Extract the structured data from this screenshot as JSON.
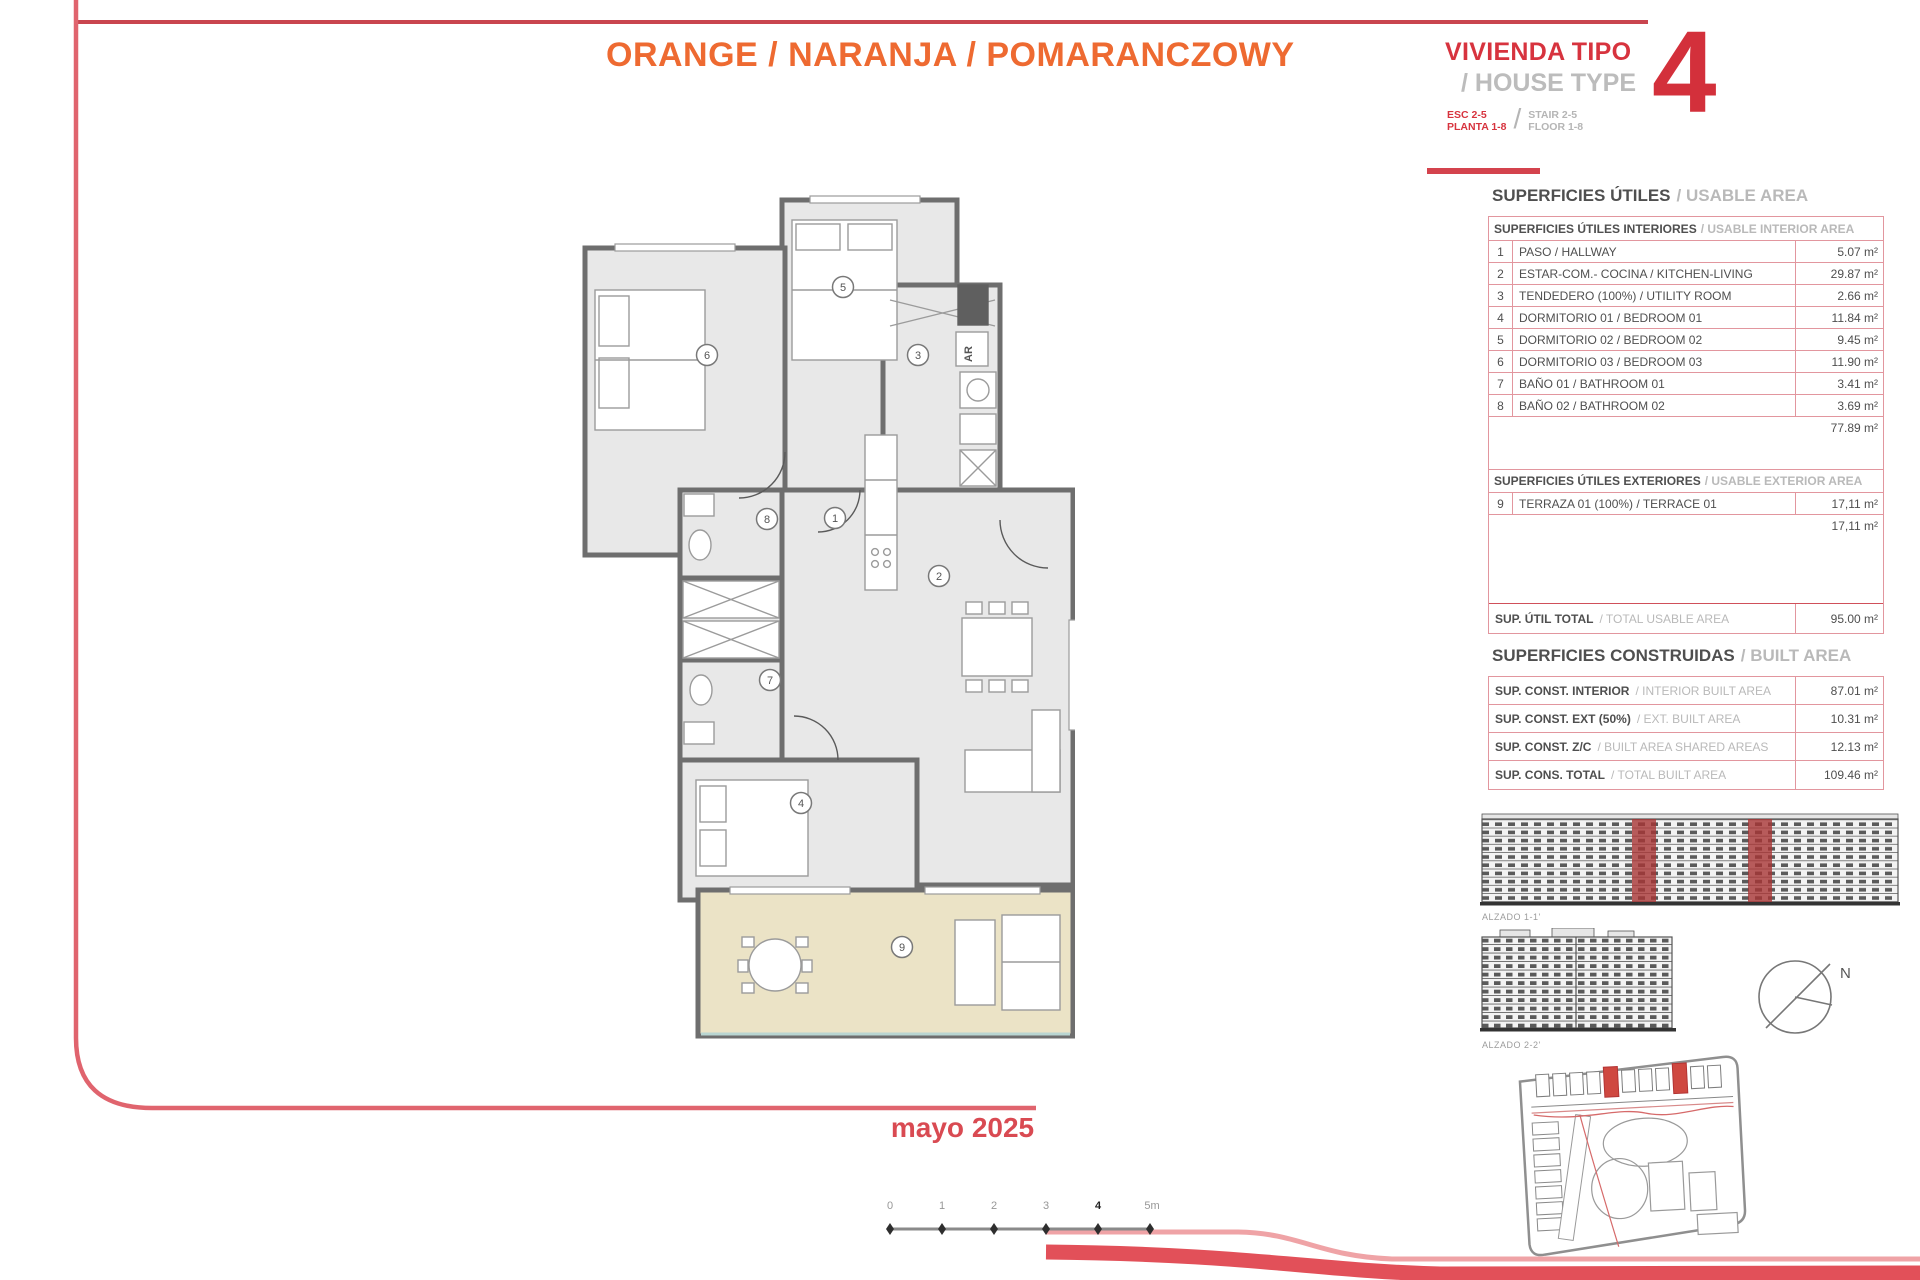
{
  "header": {
    "title": "ORANGE / NARANJA / POMARANCZOWY",
    "type_block": {
      "line1": "VIVIENDA TIPO",
      "line2": "/ HOUSE TYPE",
      "esc": "ESC 2-5",
      "planta": "PLANTA 1-8",
      "stair": "STAIR 2-5",
      "floor": "FLOOR 1-8",
      "number": "4"
    }
  },
  "usable_area": {
    "title_es": "SUPERFICIES ÚTILES",
    "title_en": "/ USABLE AREA",
    "interior": {
      "header_es": "SUPERFICIES ÚTILES INTERIORES",
      "header_en": "/ USABLE INTERIOR AREA",
      "rows": [
        {
          "num": "1",
          "label": "PASO / HALLWAY",
          "value": "5.07 m²"
        },
        {
          "num": "2",
          "label": "ESTAR-COM.- COCINA / KITCHEN-LIVING",
          "value": "29.87 m²"
        },
        {
          "num": "3",
          "label": "TENDEDERO (100%) / UTILITY ROOM",
          "value": "2.66 m²"
        },
        {
          "num": "4",
          "label": "DORMITORIO 01 / BEDROOM 01",
          "value": "11.84 m²"
        },
        {
          "num": "5",
          "label": "DORMITORIO 02 / BEDROOM 02",
          "value": "9.45 m²"
        },
        {
          "num": "6",
          "label": "DORMITORIO 03 / BEDROOM 03",
          "value": "11.90 m²"
        },
        {
          "num": "7",
          "label": "BAÑO 01 / BATHROOM 01",
          "value": "3.41 m²"
        },
        {
          "num": "8",
          "label": "BAÑO 02 / BATHROOM 02",
          "value": "3.69 m²"
        }
      ],
      "subtotal": "77.89 m²"
    },
    "exterior": {
      "header_es": "SUPERFICIES ÚTILES EXTERIORES",
      "header_en": "/ USABLE EXTERIOR AREA",
      "rows": [
        {
          "num": "9",
          "label": "TERRAZA 01 (100%) / TERRACE 01",
          "value": "17,11 m²"
        }
      ],
      "subtotal": "17,11 m²"
    },
    "total_es": "SUP. ÚTIL TOTAL",
    "total_en": "/ TOTAL USABLE AREA",
    "total_value": "95.00 m²"
  },
  "built_area": {
    "title_es": "SUPERFICIES CONSTRUIDAS",
    "title_en": "/ BUILT AREA",
    "rows": [
      {
        "label_es": "SUP. CONST. INTERIOR",
        "label_en": "/ INTERIOR BUILT AREA",
        "value": "87.01 m²"
      },
      {
        "label_es": "SUP. CONST. EXT (50%)",
        "label_en": "/ EXT. BUILT AREA",
        "value": "10.31 m²"
      },
      {
        "label_es": "SUP. CONST. Z/C",
        "label_en": "/ BUILT AREA SHARED AREAS",
        "value": "12.13 m²"
      },
      {
        "label_es": "SUP. CONS. TOTAL",
        "label_en": "/ TOTAL BUILT AREA",
        "value": "109.46 m²"
      }
    ]
  },
  "plan": {
    "room_numbers": [
      "1",
      "2",
      "3",
      "4",
      "5",
      "6",
      "7",
      "8",
      "9"
    ],
    "closet_label": "AR"
  },
  "elevations": {
    "alzado1": "ALZADO 1-1'",
    "alzado2": "ALZADO 2-2'"
  },
  "compass_label": "N",
  "date": "mayo 2025",
  "scale_bar": {
    "labels": [
      "0",
      "1",
      "2",
      "3",
      "4",
      "5m"
    ]
  },
  "colors": {
    "orange": "#ee6a31",
    "red": "#d7333e",
    "pink_border": "#e2969e",
    "beige_terrace": "#ebe3c6"
  }
}
